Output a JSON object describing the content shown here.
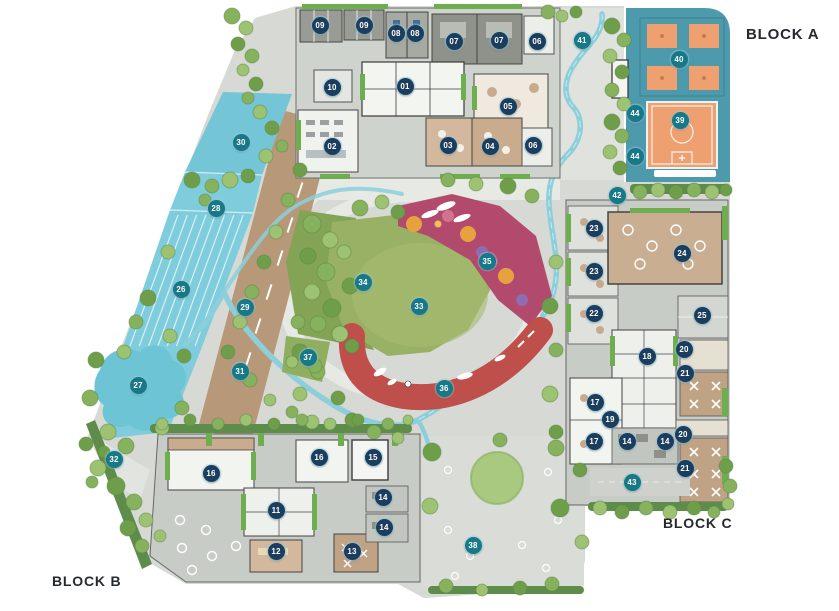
{
  "labels": {
    "block_a": "BLOCK A",
    "block_b": "BLOCK B",
    "block_c": "BLOCK C"
  },
  "marker_styles": {
    "navy": "#1c3e5e",
    "teal": "#177888",
    "navy_max_number": 25
  },
  "markers": [
    {
      "n": "01",
      "x": 405,
      "y": 86
    },
    {
      "n": "02",
      "x": 332,
      "y": 146
    },
    {
      "n": "03",
      "x": 448,
      "y": 145
    },
    {
      "n": "04",
      "x": 490,
      "y": 146
    },
    {
      "n": "05",
      "x": 508,
      "y": 106
    },
    {
      "n": "06",
      "x": 537,
      "y": 41
    },
    {
      "n": "06",
      "x": 533,
      "y": 145
    },
    {
      "n": "07",
      "x": 454,
      "y": 41
    },
    {
      "n": "07",
      "x": 499,
      "y": 40
    },
    {
      "n": "08",
      "x": 396,
      "y": 33
    },
    {
      "n": "08",
      "x": 415,
      "y": 33
    },
    {
      "n": "09",
      "x": 320,
      "y": 25
    },
    {
      "n": "09",
      "x": 364,
      "y": 25
    },
    {
      "n": "10",
      "x": 332,
      "y": 87
    },
    {
      "n": "11",
      "x": 276,
      "y": 510
    },
    {
      "n": "12",
      "x": 276,
      "y": 551
    },
    {
      "n": "13",
      "x": 352,
      "y": 551
    },
    {
      "n": "14",
      "x": 383,
      "y": 497
    },
    {
      "n": "14",
      "x": 384,
      "y": 527
    },
    {
      "n": "14",
      "x": 627,
      "y": 441
    },
    {
      "n": "14",
      "x": 665,
      "y": 441
    },
    {
      "n": "15",
      "x": 373,
      "y": 457
    },
    {
      "n": "16",
      "x": 211,
      "y": 473
    },
    {
      "n": "16",
      "x": 319,
      "y": 457
    },
    {
      "n": "17",
      "x": 595,
      "y": 402
    },
    {
      "n": "17",
      "x": 594,
      "y": 441
    },
    {
      "n": "18",
      "x": 647,
      "y": 356
    },
    {
      "n": "19",
      "x": 610,
      "y": 419
    },
    {
      "n": "20",
      "x": 684,
      "y": 349
    },
    {
      "n": "20",
      "x": 683,
      "y": 434
    },
    {
      "n": "21",
      "x": 685,
      "y": 373
    },
    {
      "n": "21",
      "x": 685,
      "y": 468
    },
    {
      "n": "22",
      "x": 594,
      "y": 313
    },
    {
      "n": "23",
      "x": 594,
      "y": 228
    },
    {
      "n": "23",
      "x": 594,
      "y": 271
    },
    {
      "n": "24",
      "x": 682,
      "y": 253
    },
    {
      "n": "25",
      "x": 702,
      "y": 315
    },
    {
      "n": "26",
      "x": 181,
      "y": 289
    },
    {
      "n": "27",
      "x": 138,
      "y": 385
    },
    {
      "n": "28",
      "x": 216,
      "y": 208
    },
    {
      "n": "29",
      "x": 245,
      "y": 307
    },
    {
      "n": "30",
      "x": 241,
      "y": 142
    },
    {
      "n": "31",
      "x": 240,
      "y": 371
    },
    {
      "n": "32",
      "x": 114,
      "y": 459
    },
    {
      "n": "33",
      "x": 419,
      "y": 306
    },
    {
      "n": "34",
      "x": 363,
      "y": 282
    },
    {
      "n": "35",
      "x": 487,
      "y": 261
    },
    {
      "n": "36",
      "x": 444,
      "y": 388
    },
    {
      "n": "37",
      "x": 308,
      "y": 357
    },
    {
      "n": "38",
      "x": 473,
      "y": 545
    },
    {
      "n": "39",
      "x": 680,
      "y": 120
    },
    {
      "n": "40",
      "x": 679,
      "y": 59
    },
    {
      "n": "41",
      "x": 582,
      "y": 40
    },
    {
      "n": "42",
      "x": 617,
      "y": 195
    },
    {
      "n": "43",
      "x": 632,
      "y": 482
    },
    {
      "n": "44",
      "x": 635,
      "y": 113
    },
    {
      "n": "44",
      "x": 635,
      "y": 156
    }
  ]
}
